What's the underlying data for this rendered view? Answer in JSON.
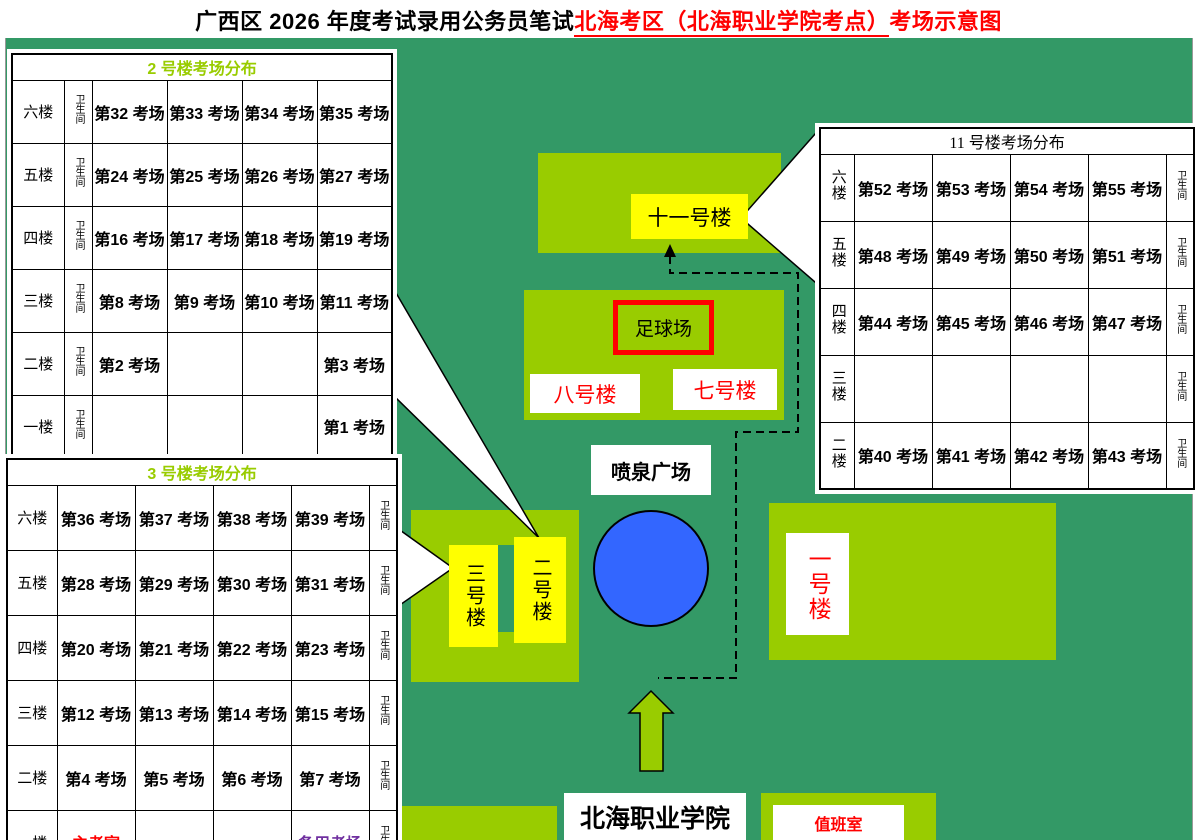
{
  "title": {
    "part1": "广西区 2026 年度考试录用公务员笔试",
    "part2": "北海考区（北海职业学院考点）",
    "part3": "考场示意图"
  },
  "toilet_label": "卫生间",
  "tables": {
    "b2": {
      "title": "2 号楼考场分布",
      "rows": [
        {
          "floor": "六楼",
          "cells": [
            "第32 考场",
            "第33 考场",
            "第34 考场",
            "第35 考场"
          ]
        },
        {
          "floor": "五楼",
          "cells": [
            "第24 考场",
            "第25 考场",
            "第26 考场",
            "第27 考场"
          ]
        },
        {
          "floor": "四楼",
          "cells": [
            "第16 考场",
            "第17 考场",
            "第18 考场",
            "第19 考场"
          ]
        },
        {
          "floor": "三楼",
          "cells": [
            "第8 考场",
            "第9 考场",
            "第10 考场",
            "第11 考场"
          ]
        },
        {
          "floor": "二楼",
          "cells": [
            "第2 考场",
            "",
            "",
            "第3 考场"
          ]
        },
        {
          "floor": "一楼",
          "cells": [
            "",
            "",
            "",
            "第1 考场"
          ]
        }
      ]
    },
    "b3": {
      "title": "3 号楼考场分布",
      "rows": [
        {
          "floor": "六楼",
          "cells": [
            "第36 考场",
            "第37 考场",
            "第38 考场",
            "第39 考场"
          ]
        },
        {
          "floor": "五楼",
          "cells": [
            "第28 考场",
            "第29 考场",
            "第30 考场",
            "第31 考场"
          ]
        },
        {
          "floor": "四楼",
          "cells": [
            "第20 考场",
            "第21 考场",
            "第22 考场",
            "第23 考场"
          ]
        },
        {
          "floor": "三楼",
          "cells": [
            "第12 考场",
            "第13 考场",
            "第14 考场",
            "第15 考场"
          ]
        },
        {
          "floor": "二楼",
          "cells": [
            "第4 考场",
            "第5 考场",
            "第6 考场",
            "第7 考场"
          ]
        },
        {
          "floor": "一楼",
          "cells": [
            "主考室",
            "",
            "",
            "备用考场"
          ]
        }
      ]
    },
    "b11": {
      "title": "11 号楼考场分布",
      "rows": [
        {
          "floor": "六楼",
          "cells": [
            "第52 考场",
            "第53 考场",
            "第54 考场",
            "第55 考场"
          ]
        },
        {
          "floor": "五楼",
          "cells": [
            "第48 考场",
            "第49 考场",
            "第50 考场",
            "第51 考场"
          ]
        },
        {
          "floor": "四楼",
          "cells": [
            "第44 考场",
            "第45 考场",
            "第46 考场",
            "第47 考场"
          ]
        },
        {
          "floor": "三楼",
          "cells": [
            "",
            "",
            "",
            ""
          ]
        },
        {
          "floor": "二楼",
          "cells": [
            "第40 考场",
            "第41 考场",
            "第42 考场",
            "第43 考场"
          ]
        }
      ]
    }
  },
  "cell_colors": {
    "主考室": "#FF0000",
    "备用考场": "#7030A0"
  },
  "map_labels": {
    "building11": "十一号楼",
    "football_field": "足球场",
    "building8": "八号楼",
    "building7": "七号楼",
    "fountain_square": "喷泉广场",
    "building3": "三号楼",
    "building2": "二号楼",
    "building1": "一号楼",
    "college": "北海职业学院",
    "duty_room": "值班室"
  },
  "colors": {
    "background_green": "#339966",
    "building_green": "#99CC00",
    "highlight_yellow": "#FFFF00",
    "fountain_blue": "#3366FF",
    "accent_red": "#FF0000",
    "backup_room_purple": "#7030A0",
    "table_header_green": "#99CC00"
  }
}
